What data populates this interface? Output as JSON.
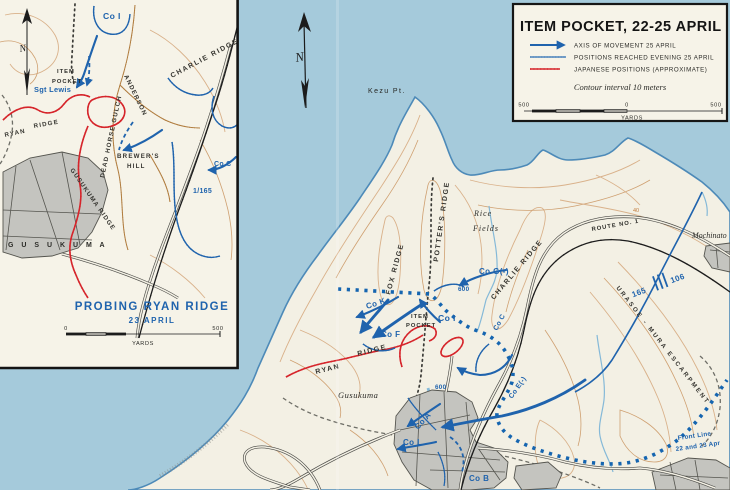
{
  "colors": {
    "sea": "#a5cadb",
    "land": "#f3f0e4",
    "box_background": "#f6f3e8",
    "military_blue": "#1f63ad",
    "japanese_red": "#d6252b",
    "contour_tan": "#d9b18a",
    "town_gray": "#c4c4bf"
  },
  "title_box": {
    "title": "ITEM POCKET, 22-25 APRIL",
    "legend": [
      {
        "symbol": "axis-arrow",
        "label": "AXIS OF MOVEMENT 25 APRIL"
      },
      {
        "symbol": "blue-hatched-line",
        "label": "POSITIONS REACHED EVENING 25 APRIL"
      },
      {
        "symbol": "red-comb-line",
        "label": "JAPANESE POSITIONS (APPROXIMATE)"
      }
    ],
    "contour_note": "Contour interval 10 meters",
    "scale": {
      "left": "500",
      "zero": "0",
      "right": "500",
      "unit": "YARDS"
    }
  },
  "inset": {
    "north": "N",
    "labels": {
      "co_i": "Co I",
      "charlie_ridge": "CHARLIE  RIDGE",
      "item": "ITEM",
      "pocket": "POCKET",
      "sgt_lewis": "Sgt Lewis",
      "anderson": "ANDERSON",
      "dead_horse_gulch": "DEAD HORSE GULCH",
      "ryan": "RYAN",
      "ridge": "RIDGE",
      "gusukuma_ridge": "GUSUKUMA  RIDGE",
      "brewers": "BREWER'S",
      "hill": "HILL",
      "co_c": "Co C",
      "one_165": "1/165",
      "gusukuma": "G U S U K U M A"
    },
    "title": "PROBING  RYAN  RIDGE",
    "subtitle": "23  APRIL",
    "scale": {
      "left": "0",
      "right": "500",
      "unit": "YARDS"
    }
  },
  "main": {
    "north": "N",
    "labels": {
      "kezu_pt": "Kezu  Pt.",
      "rice": "Rice",
      "fields": "Fields",
      "fox_ridge": "FOX  RIDGE",
      "potters_ridge": "POTTER'S  RIDGE",
      "charlie_ridge": "CHARLIE  RIDGE",
      "ryan": "RYAN",
      "ridge": "RIDGE",
      "item": "ITEM",
      "pocket": "POCKET",
      "co_g": "Co G(-)",
      "co_k": "Co K",
      "co_f": "Co F",
      "co_i": "Co I",
      "co_c": "Co C",
      "co_e": "Co E(-)",
      "co_a": "Co A",
      "co_l": "Co L",
      "co_b": "Co B",
      "elev_600_a": "600",
      "elev_600_b": "600",
      "elev_40": "40",
      "gusukuma": "Gusukuma",
      "mochinato": "Mochinato",
      "route": "ROUTE  NO. 1",
      "boundary_left": "165",
      "boundary_right": "106",
      "escarpment": "URASOE - MURA   ESCARPMENT",
      "front_line_1": "Front  Line",
      "front_line_2": "22 and 23 Apr"
    }
  }
}
